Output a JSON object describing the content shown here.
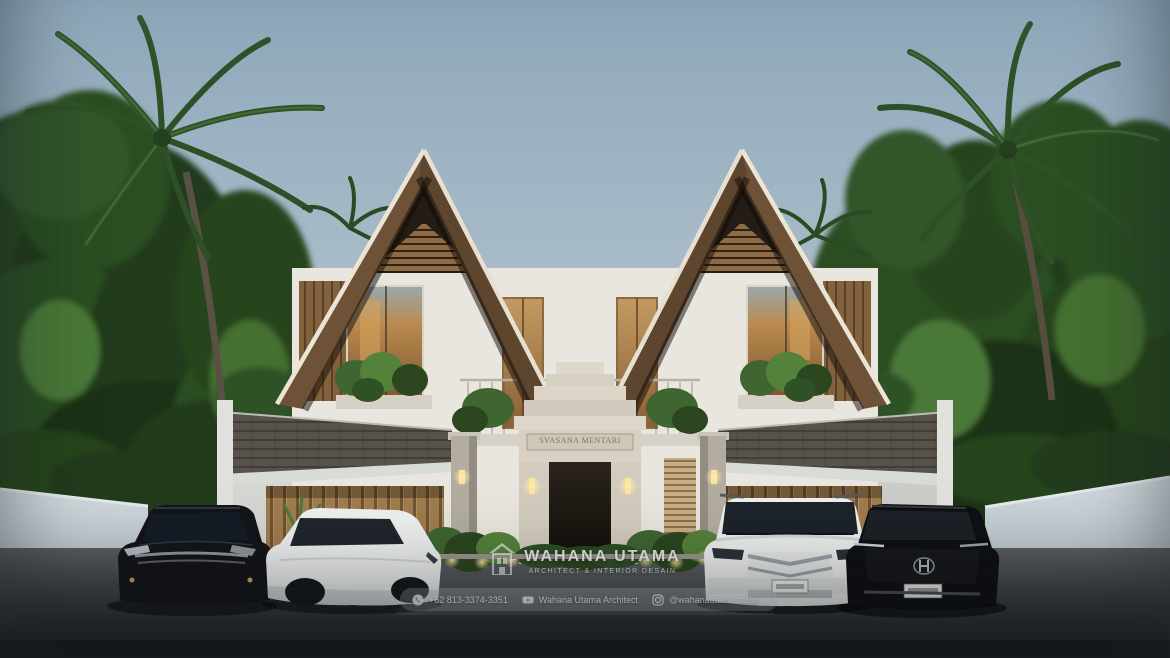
{
  "scene": {
    "type": "3D architectural exterior rendering",
    "subject": "Two-storey tropical duplex villa with twin gabled roofs, central Balinese stone gate, palm trees and four parked cars",
    "car_count": 4
  },
  "gate": {
    "sign": "SVASANA MENTARI"
  },
  "watermark": {
    "title": "WAHANA UTAMA",
    "subtitle": "ARCHITECT & INTERIOR DESAIN"
  },
  "contact": {
    "phone": "+62 813-3374-3351",
    "youtube": "Wahana Utama Architect",
    "instagram": "@wahanautamastudio"
  },
  "colors": {
    "sky_top": "#8fa8bb",
    "sky_bottom": "#cdd9df",
    "foliage_dark": "#203a1c",
    "foliage_mid": "#2c4d24",
    "foliage_light": "#4a7838",
    "roof_wood": "#6e5238",
    "roof_fascia": "#ece5d5",
    "gable_slats": "#8e6a45",
    "wall_white": "#e9e6df",
    "window_glow": "#b98a4e",
    "garage_wood": "#a07c4e",
    "shingle_gray": "#57524a",
    "gate_stone": "#d8d1c3",
    "compound_wall": "#c6cfd4",
    "road": "#3b3f42",
    "uplight": "#ffe59a"
  }
}
